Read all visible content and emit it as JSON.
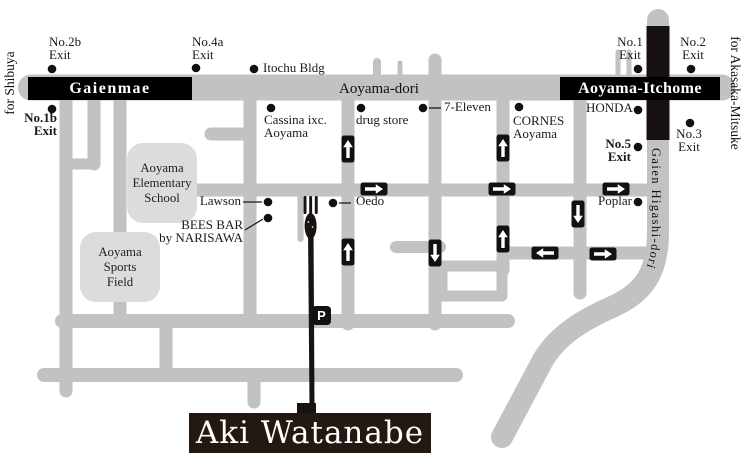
{
  "canvas": {
    "w": 746,
    "h": 471
  },
  "colors": {
    "road": "#c2c2c2",
    "building": "#dcdcdc",
    "ink": "#1a1a1a",
    "black_road": "#161010",
    "banner_bg": "#241912"
  },
  "banner": {
    "label": "Aki Watanabe"
  },
  "parking": {
    "label": "P"
  },
  "stations": [
    {
      "id": "gaienmae",
      "label": "Gaienmae"
    },
    {
      "id": "aoyama-itchome",
      "label": "Aoyama-Itchome"
    }
  ],
  "road_labels": {
    "aoyama_dori": "Aoyama-dori",
    "gaien_higashi_dori": "Gaien Higashi-dori"
  },
  "edge_labels": [
    {
      "id": "for-shibuya",
      "text": "for Shibuya"
    },
    {
      "id": "for-akasaka-mitsuke",
      "text": "for Akasaka-Mitsuke"
    }
  ],
  "labels": [
    {
      "id": "exit-no2b",
      "lines": [
        "No.2b",
        "Exit"
      ],
      "x": 49,
      "y": 36,
      "align": "left",
      "bold": false
    },
    {
      "id": "exit-no4a",
      "lines": [
        "No.4a",
        "Exit"
      ],
      "x": 192,
      "y": 36,
      "align": "left",
      "bold": false
    },
    {
      "id": "exit-no1",
      "lines": [
        "No.1",
        "Exit"
      ],
      "x": 630,
      "y": 36,
      "align": "center",
      "bold": false
    },
    {
      "id": "exit-no2",
      "lines": [
        "No.2",
        "Exit"
      ],
      "x": 693,
      "y": 36,
      "align": "center",
      "bold": false
    },
    {
      "id": "exit-no1b",
      "lines": [
        "No.1b",
        "Exit"
      ],
      "x": 57,
      "y": 112,
      "align": "right",
      "bold": true
    },
    {
      "id": "exit-no3",
      "lines": [
        "No.3",
        "Exit"
      ],
      "x": 689,
      "y": 128,
      "align": "center",
      "bold": false
    },
    {
      "id": "exit-no5",
      "lines": [
        "No.5",
        "Exit"
      ],
      "x": 631,
      "y": 138,
      "align": "right",
      "bold": true
    },
    {
      "id": "itochu-bldg",
      "lines": [
        "Itochu Bldg"
      ],
      "x": 263,
      "y": 62,
      "align": "left",
      "bold": false
    },
    {
      "id": "cassina",
      "lines": [
        "Cassina ixc.",
        "Aoyama"
      ],
      "x": 264,
      "y": 114,
      "align": "left",
      "bold": false
    },
    {
      "id": "drug-store",
      "lines": [
        "drug store"
      ],
      "x": 356,
      "y": 114,
      "align": "left",
      "bold": false
    },
    {
      "id": "seven-eleven",
      "lines": [
        "7-Eleven"
      ],
      "x": 444,
      "y": 101,
      "align": "left",
      "bold": false
    },
    {
      "id": "cornes",
      "lines": [
        "CORNES",
        "Aoyama"
      ],
      "x": 513,
      "y": 115,
      "align": "left",
      "bold": false
    },
    {
      "id": "honda",
      "lines": [
        "HONDA"
      ],
      "x": 586,
      "y": 102,
      "align": "left",
      "bold": false
    },
    {
      "id": "lawson",
      "lines": [
        "Lawson"
      ],
      "x": 241,
      "y": 195,
      "align": "right",
      "bold": false
    },
    {
      "id": "bees-bar",
      "lines": [
        "BEES BAR",
        "by NARISAWA"
      ],
      "x": 243,
      "y": 219,
      "align": "right",
      "bold": false
    },
    {
      "id": "oedo",
      "lines": [
        "Oedo"
      ],
      "x": 356,
      "y": 195,
      "align": "left",
      "bold": false
    },
    {
      "id": "poplar",
      "lines": [
        "Poplar"
      ],
      "x": 632,
      "y": 195,
      "align": "right",
      "bold": false
    }
  ],
  "dots": [
    [
      52,
      69
    ],
    [
      196,
      68
    ],
    [
      638,
      69
    ],
    [
      691,
      69
    ],
    [
      52,
      109
    ],
    [
      690,
      123
    ],
    [
      638,
      147
    ],
    [
      254,
      69
    ],
    [
      271,
      108
    ],
    [
      361,
      108
    ],
    [
      423,
      108
    ],
    [
      519,
      107
    ],
    [
      638,
      110
    ],
    [
      268,
      202
    ],
    [
      268,
      218
    ],
    [
      333,
      203
    ],
    [
      638,
      202
    ]
  ],
  "leader_lines": [
    [
      429,
      108,
      441,
      108
    ],
    [
      243,
      202,
      262,
      202
    ],
    [
      245,
      230,
      263,
      219
    ],
    [
      339,
      203,
      351,
      203
    ]
  ],
  "arrows": [
    {
      "dir": "up",
      "x": 348,
      "y": 149
    },
    {
      "dir": "up",
      "x": 503,
      "y": 148
    },
    {
      "dir": "right",
      "x": 374,
      "y": 189
    },
    {
      "dir": "right",
      "x": 502,
      "y": 189
    },
    {
      "dir": "right",
      "x": 616,
      "y": 189
    },
    {
      "dir": "down",
      "x": 578,
      "y": 214
    },
    {
      "dir": "up",
      "x": 503,
      "y": 239
    },
    {
      "dir": "up",
      "x": 348,
      "y": 252
    },
    {
      "dir": "down",
      "x": 435,
      "y": 253
    },
    {
      "dir": "left",
      "x": 545,
      "y": 253
    },
    {
      "dir": "right",
      "x": 603,
      "y": 254
    }
  ],
  "buildings": [
    {
      "id": "aoyama-elementary-school",
      "lines": [
        "Aoyama",
        "Elementary",
        "School"
      ],
      "x": 127,
      "y": 143,
      "w": 70,
      "h": 80
    },
    {
      "id": "aoyama-sports-field",
      "lines": [
        "Aoyama",
        "Sports",
        "Field"
      ],
      "x": 80,
      "y": 232,
      "w": 80,
      "h": 70
    }
  ]
}
